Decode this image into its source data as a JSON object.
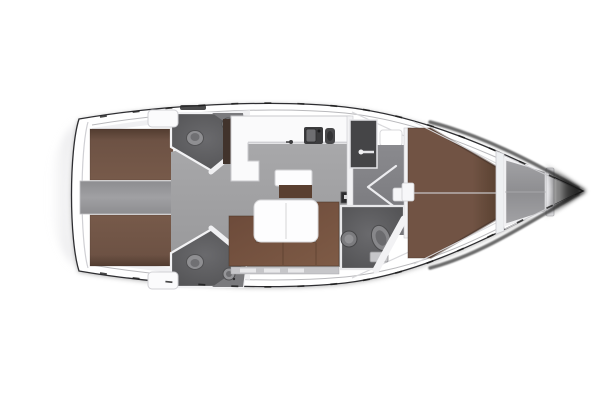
{
  "meta": {
    "title": "Sailing yacht interior deck plan",
    "view": "top-down floor plan",
    "orientation": "bow-right"
  },
  "rooms": [
    {
      "name": "swim-platform"
    },
    {
      "name": "aft-cabin-port"
    },
    {
      "name": "aft-cabin-starboard"
    },
    {
      "name": "engine-companionway"
    },
    {
      "name": "aft-head-port"
    },
    {
      "name": "aft-head-starboard"
    },
    {
      "name": "galley"
    },
    {
      "name": "salon"
    },
    {
      "name": "forward-corridor"
    },
    {
      "name": "wardrobe"
    },
    {
      "name": "forward-head"
    },
    {
      "name": "owners-cabin-vberth"
    },
    {
      "name": "anchor-locker"
    }
  ],
  "colors": {
    "background": "#ffffff",
    "hull_fill": "#ffffff",
    "hull_outline": "#2e2e30",
    "inner_rail": "#b9b9bc",
    "deck_shade": "#ececef",
    "wall_white": "#f2f2f4",
    "wall_stroke": "#c9c9cd",
    "door_white": "#f0f0f2",
    "berth_brown": "#6d5244",
    "berth_brown_dark": "#523c30",
    "berth_brown_light": "#775a4a",
    "vberth_brown": "#715344",
    "vberth_brown_dark": "#57402f",
    "sofa_brown_dark": "#6b4939",
    "sofa_brown_light": "#7e5b46",
    "cabinet_brown": "#5a3f30",
    "table_white": "#fdfdfe",
    "salon_floor_light": "#a8a8aa",
    "salon_floor_dark": "#98989a",
    "engine_strip": "#a0a0a3",
    "engine_strip_edge": "#8d8d90",
    "corridor_light": "#8a8a8e",
    "corridor_dark": "#76767a",
    "head_light": "#6a6a6d",
    "head_dark": "#4e4e50",
    "fixture_light": "#8f8f92",
    "fixture_rim": "#525254",
    "counter_white": "#fafafb",
    "sink_dark": "#3c3c3e",
    "wardrobe_dark": "#454547",
    "locker_light": "#a2a2a5",
    "locker_dark": "#8e8e91",
    "step_white": "#f2f2f4",
    "bow_shadow": "#0d0d0d",
    "platform_gray": "#d8d8dc",
    "traveler_dark": "#2b2b2d"
  }
}
